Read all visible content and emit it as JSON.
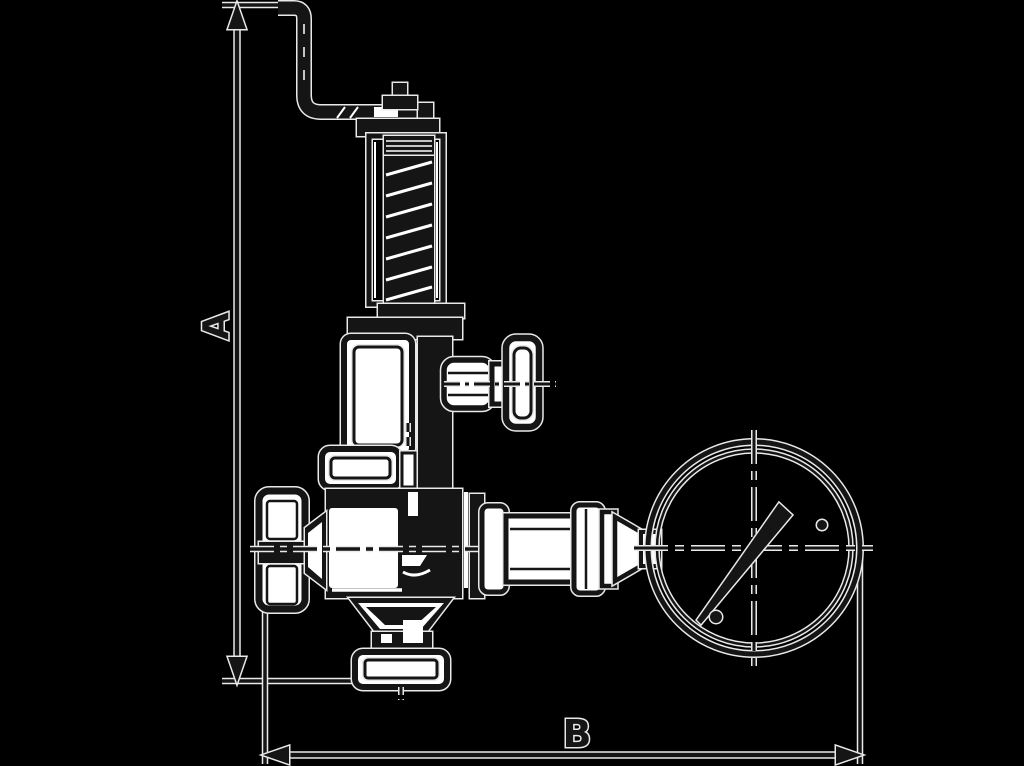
{
  "page": {
    "kind": "technical-line-drawing",
    "background": "#000000"
  },
  "colors": {
    "background": "#000000",
    "ink": "#151515",
    "paper": "#ffffff",
    "halo": "#e9e9e9"
  },
  "drawing": {
    "type": "dimensioned outline drawing",
    "subject_components": [
      "lifting-lever",
      "adjusting-stem",
      "spring-bonnet",
      "spring-coil",
      "spring-chamber",
      "test-knob",
      "upper-flange",
      "valve-body",
      "handwheel",
      "outlet-union",
      "pressure-gauge",
      "gauge-needle",
      "bottom-flange"
    ],
    "dimensions": {
      "vertical": {
        "label": "A"
      },
      "horizontal": {
        "label": "B"
      }
    }
  }
}
